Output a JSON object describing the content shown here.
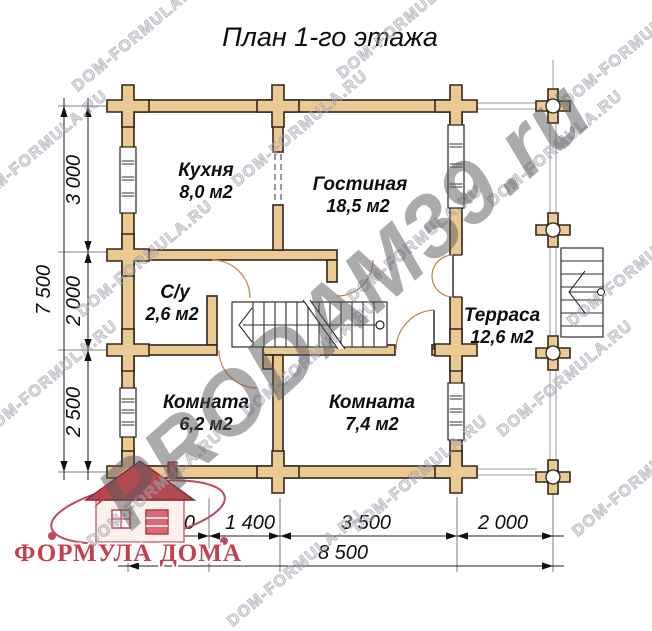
{
  "title": "План 1-го этажа",
  "rooms": {
    "kitchen": {
      "name": "Кухня",
      "area": "8,0 м2"
    },
    "living_room": {
      "name": "Гостиная",
      "area": "18,5 м2"
    },
    "bathroom": {
      "name": "С/у",
      "area": "2,6 м2"
    },
    "terrace": {
      "name": "Терраса",
      "area": "12,6 м2"
    },
    "bedroom_left": {
      "name": "Комната",
      "area": "6,2 м2"
    },
    "bedroom_right": {
      "name": "Комната",
      "area": "7,4 м2"
    }
  },
  "dimensions": {
    "left": {
      "total": "7 500",
      "segments": [
        "3 000",
        "2 000",
        "2 500"
      ]
    },
    "bottom": {
      "total": "8 500",
      "segments": [
        "1 600",
        "1 400",
        "3 500",
        "2 000"
      ]
    }
  },
  "watermarks": {
    "tile": "DOM-FORMULA.RU",
    "big": "PRODAM39.ru"
  },
  "logo": {
    "text": "ФОРМУЛА ДОМА"
  },
  "colors": {
    "wall_fill": "#ebc992",
    "wall_outline": "#33261a",
    "door_arc": "#c8834f",
    "logo_red": "#c5404e",
    "watermark_gray": "#b4b5c0",
    "watermark_big_gray": "#58585c"
  }
}
